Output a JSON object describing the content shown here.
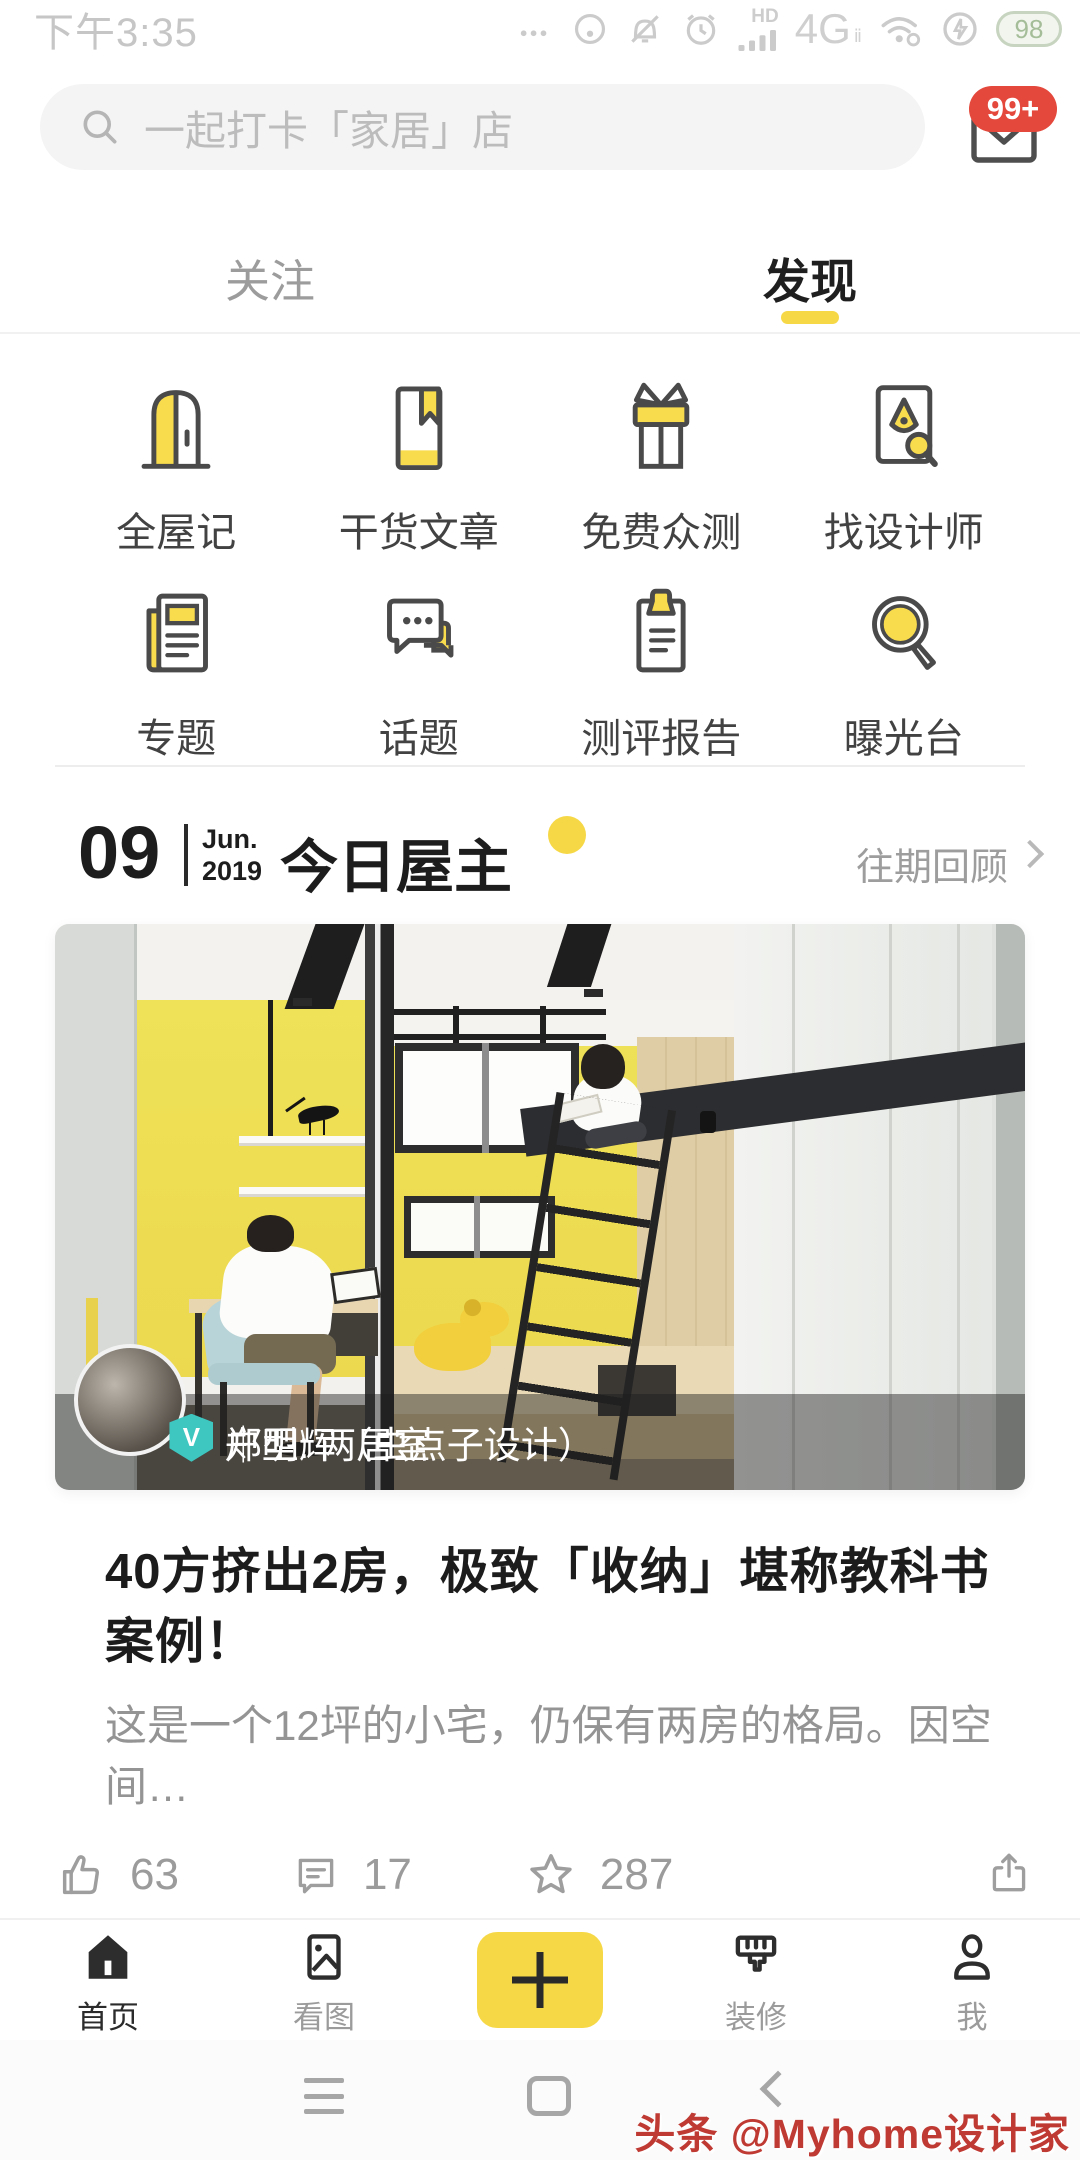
{
  "status_bar": {
    "time": "下午3:35",
    "hd_label": "HD",
    "network_label": "4G",
    "network_sub": "ⅱ",
    "battery_percent": "98",
    "icons": [
      "more-dots-icon",
      "data-saver-icon",
      "mute-bell-icon",
      "alarm-icon",
      "signal-icon",
      "wifi-icon",
      "power-save-icon",
      "battery-icon"
    ]
  },
  "search": {
    "placeholder": "一起打卡「家居」店",
    "icon": "search-icon",
    "mail_icon": "mail-icon",
    "badge": "99+"
  },
  "tabs": [
    {
      "label": "关注",
      "active": false
    },
    {
      "label": "发现",
      "active": true
    }
  ],
  "grid": {
    "items": [
      {
        "label": "全屋记",
        "icon": "door-icon"
      },
      {
        "label": "干货文章",
        "icon": "article-icon"
      },
      {
        "label": "免费众测",
        "icon": "gift-icon"
      },
      {
        "label": "找设计师",
        "icon": "designer-icon"
      },
      {
        "label": "专题",
        "icon": "feature-icon"
      },
      {
        "label": "话题",
        "icon": "topic-icon"
      },
      {
        "label": "测评报告",
        "icon": "report-icon"
      },
      {
        "label": "曝光台",
        "icon": "expose-icon"
      }
    ]
  },
  "section": {
    "day": "09",
    "month": "Jun.",
    "year": "2019",
    "title": "今日屋主",
    "more": "往期回顾"
  },
  "card": {
    "author": "郑明辉（虫点子设计）",
    "separator": "｜",
    "meta": "户型: 两居室",
    "verified_badge": "V",
    "title": "40方挤出2房，极致「收纳」堪称教科书案例！",
    "excerpt": "这是一个12坪的小宅，仍保有两房的格局。因空间…"
  },
  "engagement": {
    "likes": "63",
    "comments": "17",
    "stars": "287",
    "icons": [
      "thumb-up-icon",
      "comment-icon",
      "star-icon",
      "share-icon"
    ]
  },
  "bottom_nav": {
    "items": [
      {
        "label": "首页",
        "icon": "home-icon",
        "active": true
      },
      {
        "label": "看图",
        "icon": "gallery-icon",
        "active": false
      },
      {
        "label": "装修",
        "icon": "brush-icon",
        "active": false
      },
      {
        "label": "我",
        "icon": "profile-icon",
        "active": false
      }
    ],
    "plus_icon": "plus-icon"
  },
  "android_nav": [
    "menu-icon",
    "recent-square-icon",
    "back-icon"
  ],
  "watermark": "头条 @Myhome设计家",
  "colors": {
    "accent_yellow": "#f6d847",
    "badge_red": "#e4473b",
    "verified_teal": "#3ec7c1",
    "photo_wall_yellow": "#efe258"
  }
}
